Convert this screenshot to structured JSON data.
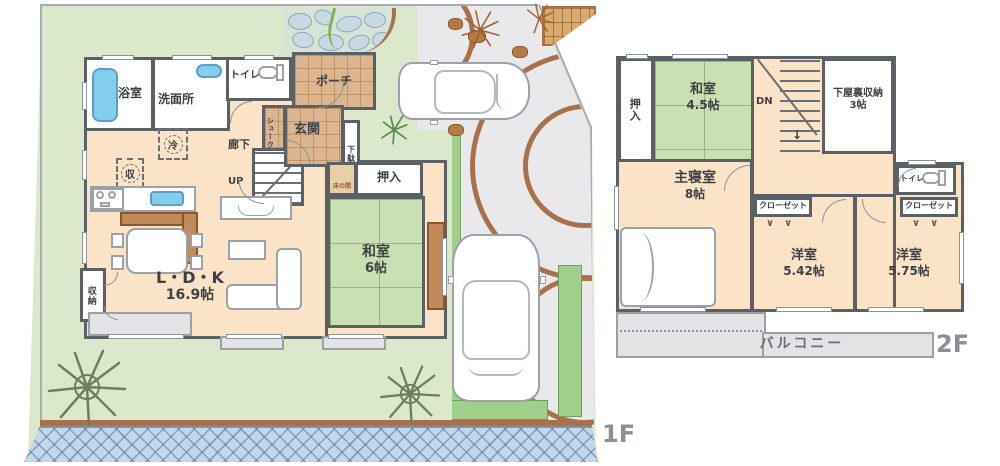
{
  "floor1": {
    "label": "1F",
    "rooms": {
      "bath": "浴室",
      "washroom": "洗面所",
      "toilet": "トイレ",
      "hallway": "廊下",
      "shoe_cloak": "シュークローク",
      "entrance": "玄関",
      "shoe_cabinet": "下駄箱",
      "porch": "ポーチ",
      "stairs_up": "UP",
      "ldk": "L・D・K",
      "ldk_size": "16.9帖",
      "storage": "収納",
      "tokonoma": "床の間",
      "closet": "押入",
      "japanese_room": "和室",
      "japanese_room_size": "6帖",
      "fridge_mark": "冷",
      "pantry_mark": "収"
    }
  },
  "floor2": {
    "label": "2F",
    "rooms": {
      "closet": "押入",
      "japanese_room": "和室",
      "japanese_room_size": "4.5帖",
      "stairs_down": "DN",
      "attic_storage": "下屋裏収納",
      "attic_storage_size": "3帖",
      "toilet": "トイレ",
      "closet_left": "クローゼット",
      "closet_right": "クローゼット",
      "master_bedroom": "主寝室",
      "master_bedroom_size": "8帖",
      "western_room_1": "洋室",
      "western_room_1_size": "5.42帖",
      "western_room_2": "洋室",
      "western_room_2_size": "5.75帖",
      "balcony": "バルコニー"
    }
  },
  "colors": {
    "wall": "#5b6065",
    "floor": "#fbe3c8",
    "tatami": "#cbe0b2",
    "lawn": "#dbe8cb",
    "road": "#c3d7ea",
    "driveway": "#e9e9ec",
    "wood": "#b5794c",
    "tile": "#dcb691",
    "water": "#85cdec",
    "balcony": "#e3e3e6"
  }
}
